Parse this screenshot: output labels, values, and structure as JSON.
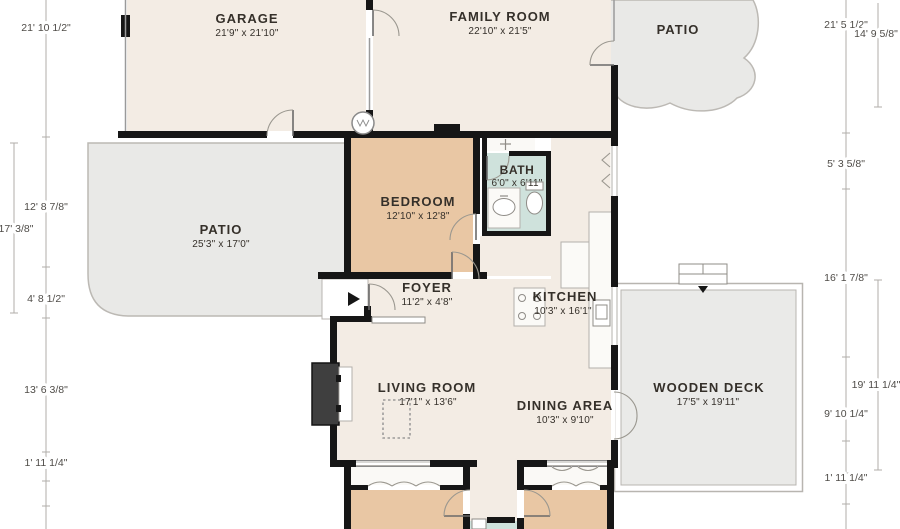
{
  "floor_plan": {
    "rooms": {
      "garage": {
        "name": "GARAGE",
        "dims": "21'9\" x 21'10\""
      },
      "family_room": {
        "name": "FAMILY ROOM",
        "dims": "22'10\" x 21'5\""
      },
      "patio_top": {
        "name": "PATIO",
        "dims": ""
      },
      "patio_left": {
        "name": "PATIO",
        "dims": "25'3\" x 17'0\""
      },
      "bedroom": {
        "name": "BEDROOM",
        "dims": "12'10\" x 12'8\""
      },
      "bath": {
        "name": "BATH",
        "dims": "6'0\" x 6'11\""
      },
      "foyer": {
        "name": "FOYER",
        "dims": "11'2\" x 4'8\""
      },
      "kitchen": {
        "name": "KITCHEN",
        "dims": "10'3\" x 16'1\""
      },
      "living_room": {
        "name": "LIVING ROOM",
        "dims": "17'1\" x 13'6\""
      },
      "dining_area": {
        "name": "DINING AREA",
        "dims": "10'3\" x 9'10\""
      },
      "wooden_deck": {
        "name": "WOODEN DECK",
        "dims": "17'5\" x 19'11\""
      }
    }
  },
  "dimensions": {
    "left_inner": [
      "21' 10 1/2\"",
      "12' 8 7/8\"",
      "4' 8 1/2\"",
      "13' 6 3/8\"",
      "1' 11 1/4\""
    ],
    "left_outer": [
      "17' 3/8\""
    ],
    "right_inner": [
      "21' 5 1/2\"",
      "5' 3 5/8\"",
      "16' 1 7/8\"",
      "9' 10 1/4\"",
      "1' 11 1/4\""
    ],
    "right_outer": [
      "14' 9 5/8\"",
      "19' 11 1/4\""
    ]
  },
  "colors": {
    "wall": "#161616",
    "room_fill": "#f3ece4",
    "bedroom_fill": "#e9c7a4",
    "bath_fill": "#cfe2dc",
    "patio_fill": "#e9e9e7",
    "deck_fill": "#eaeae8",
    "line": "#b3b0ab",
    "dim_text": "#4f4c48",
    "label_text": "#35302a"
  }
}
